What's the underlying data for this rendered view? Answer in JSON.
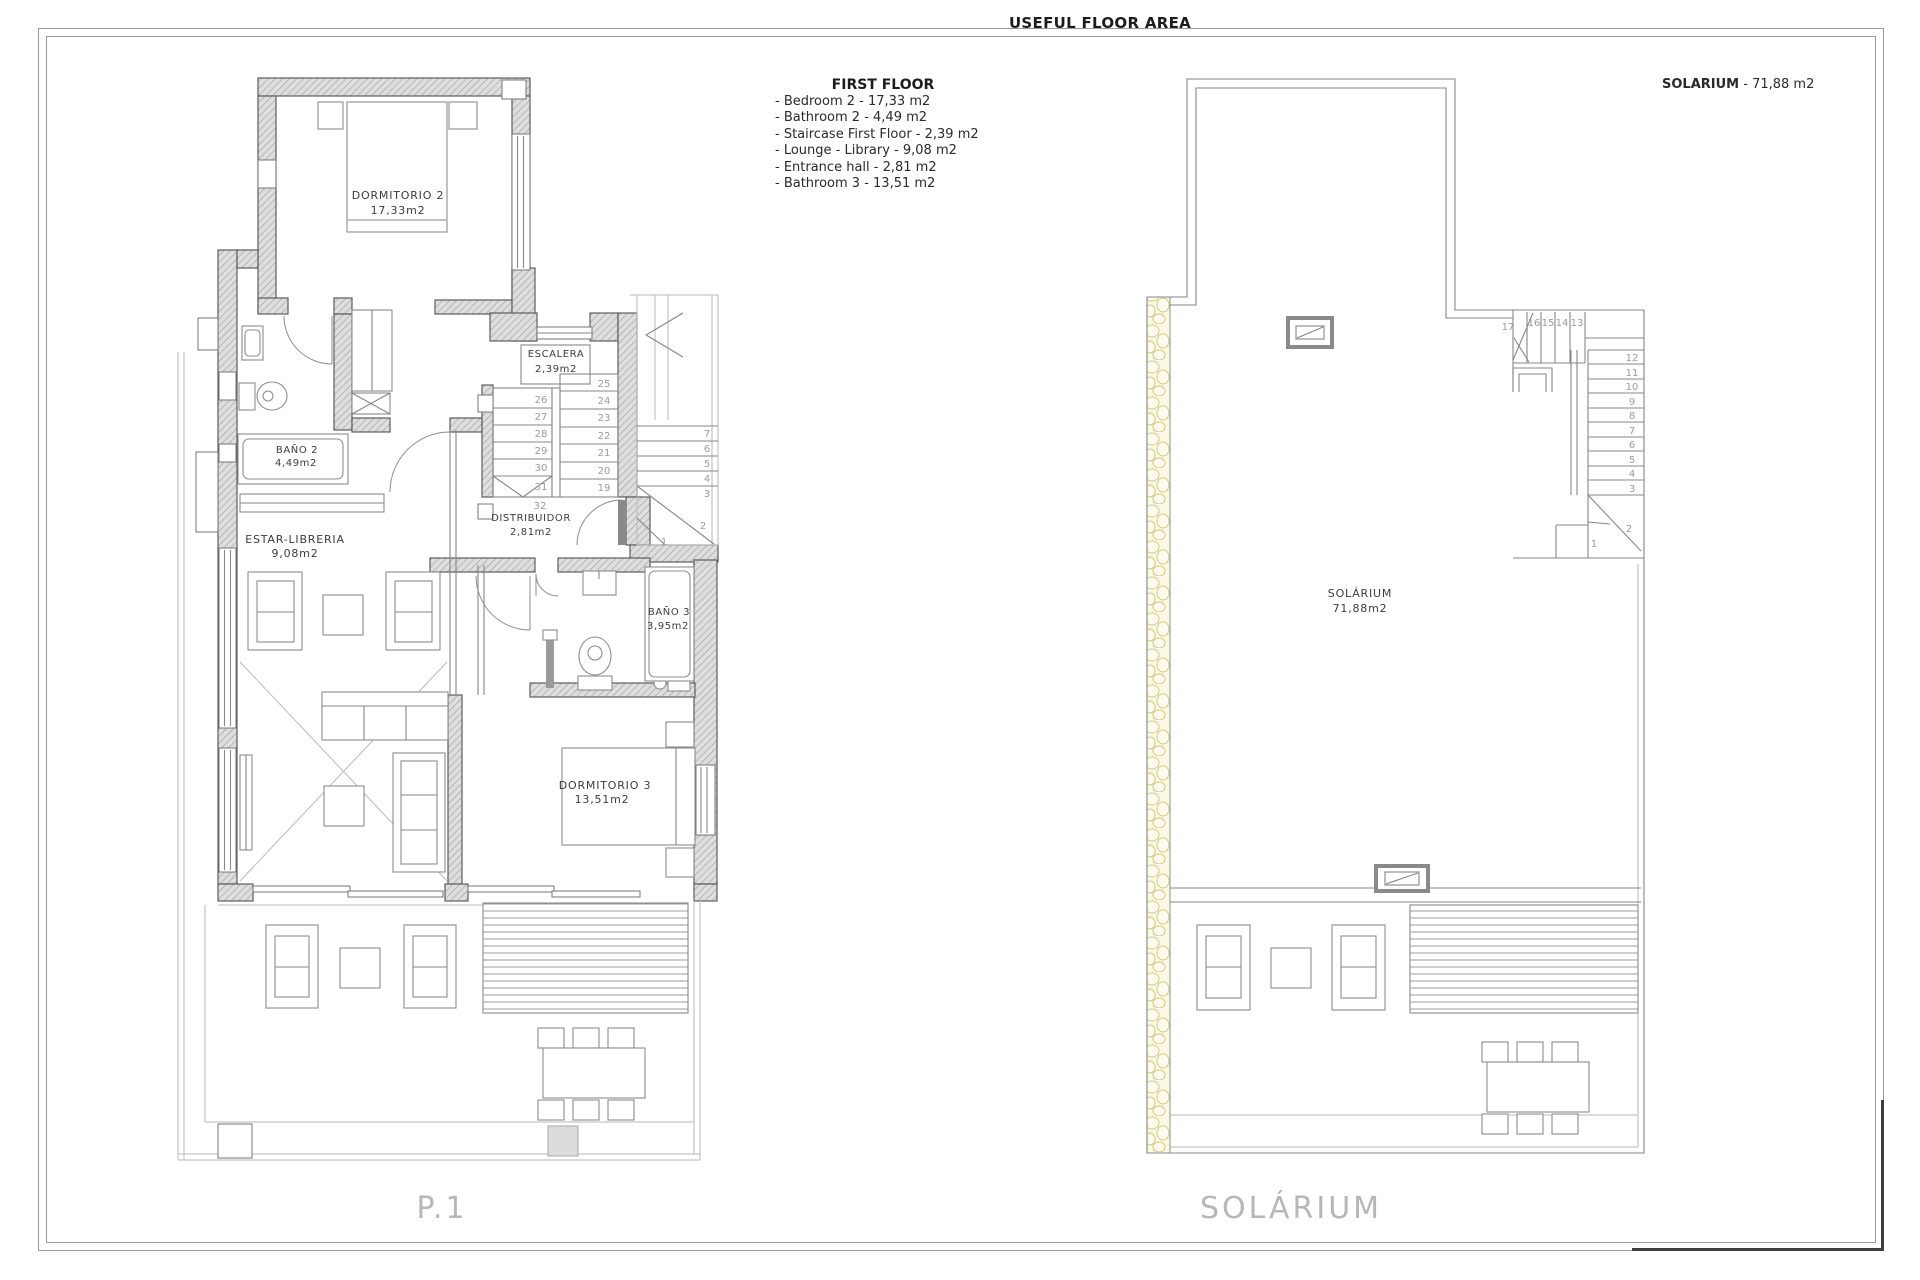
{
  "page": {
    "title": "USEFUL FLOOR AREA"
  },
  "legend": {
    "title": "FIRST FLOOR",
    "items": [
      "- Bedroom 2 - 17,33 m2",
      "- Bathroom 2 - 4,49 m2",
      "- Staircase First Floor - 2,39 m2",
      "- Lounge - Library - 9,08 m2",
      "- Entrance hall - 2,81 m2",
      "- Bathroom 3 - 13,51 m2"
    ]
  },
  "solarium_note": {
    "label": "SOLARIUM",
    "value": " - 71,88 m2"
  },
  "plan1": {
    "caption": "P.1",
    "rooms": {
      "dormitorio2": {
        "name": "DORMITORIO 2",
        "area": "17,33m2"
      },
      "bano2": {
        "name": "BAÑO 2",
        "area": "4,49m2"
      },
      "escalera": {
        "name": "ESCALERA",
        "area": "2,39m2"
      },
      "distribuidor": {
        "name": "DISTRIBUIDOR",
        "area": "2,81m2"
      },
      "estar": {
        "name": "ESTAR-LIBRERIA",
        "area": "9,08m2"
      },
      "bano3": {
        "name": "BAÑO 3",
        "area": "3,95m2"
      },
      "dormitorio3": {
        "name": "DORMITORIO 3",
        "area": "13,51m2"
      }
    },
    "stairs": {
      "left": [
        "26",
        "27",
        "28",
        "29",
        "30",
        "31"
      ],
      "right": [
        "25",
        "24",
        "23",
        "22",
        "21",
        "20",
        "19"
      ],
      "landing": "32",
      "upper": [
        "7",
        "6",
        "5",
        "4",
        "3",
        "2",
        "1"
      ]
    }
  },
  "plan2": {
    "caption": "SOLÁRIUM",
    "room": {
      "name": "SOLÁRIUM",
      "area": "71,88m2"
    },
    "stairs": {
      "top": [
        "17",
        "16",
        "15",
        "14",
        "13"
      ],
      "right": [
        "12",
        "11",
        "10",
        "9",
        "8",
        "7",
        "6",
        "5",
        "4",
        "3"
      ],
      "bottom": [
        "2",
        "1"
      ]
    }
  }
}
